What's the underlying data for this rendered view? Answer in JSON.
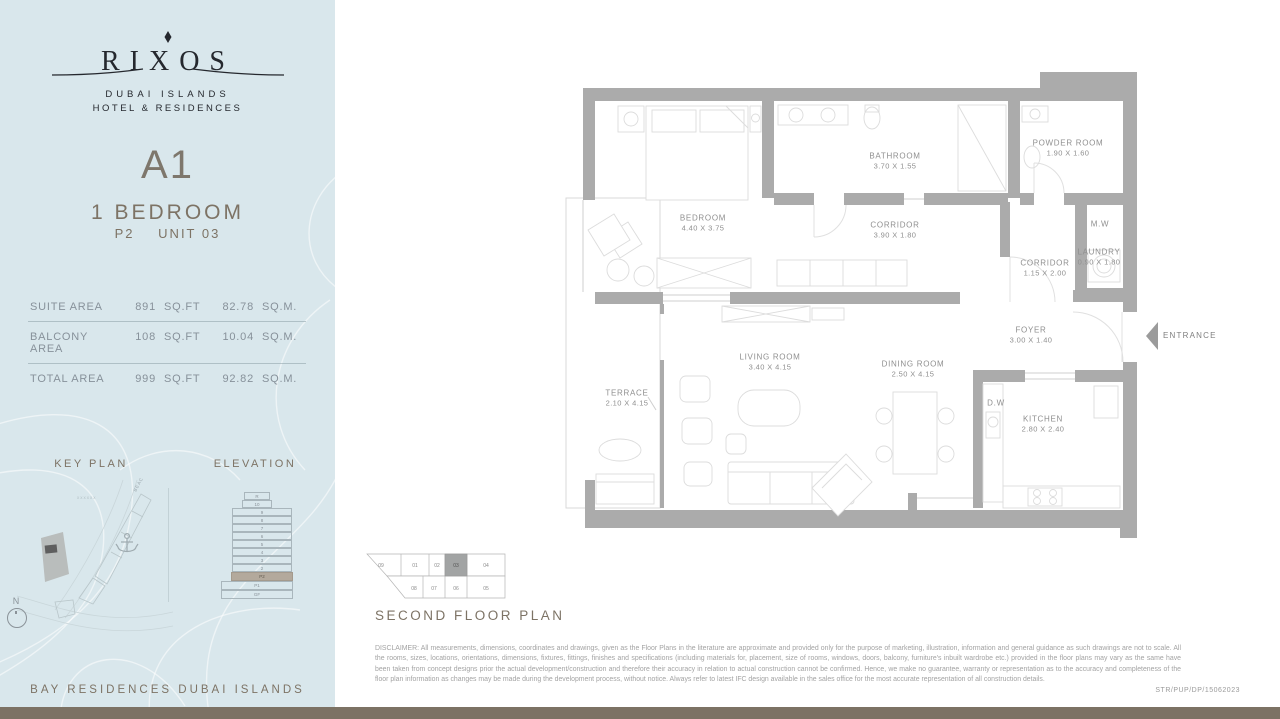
{
  "brand": {
    "name": "RIXOS",
    "sub1": "DUBAI ISLANDS",
    "sub2": "HOTEL & RESIDENCES"
  },
  "unit": {
    "code": "A1",
    "type": "1 BEDROOM",
    "level": "P2",
    "number": "UNIT 03"
  },
  "area_table": {
    "rows": [
      {
        "label": "SUITE AREA",
        "sqft": "891",
        "sqft_unit": "SQ.FT",
        "sqm": "82.78",
        "sqm_unit": "SQ.M."
      },
      {
        "label": "BALCONY AREA",
        "sqft": "108",
        "sqft_unit": "SQ.FT",
        "sqm": "10.04",
        "sqm_unit": "SQ.M."
      },
      {
        "label": "TOTAL AREA",
        "sqft": "999",
        "sqft_unit": "SQ.FT",
        "sqm": "92.82",
        "sqm_unit": "SQ.M."
      }
    ]
  },
  "key_plan": {
    "title": "KEY PLAN",
    "road_label": "BEACH VILLAS",
    "compass_label": "N"
  },
  "elevation": {
    "title": "ELEVATION",
    "floors": [
      "R",
      "10",
      "9",
      "8",
      "7",
      "6",
      "5",
      "4",
      "3",
      "2",
      "P2",
      "P1",
      "GF"
    ],
    "highlighted_floor": "P2"
  },
  "project_footer": "BAY RESIDENCES DUBAI ISLANDS",
  "floor_plan": {
    "title": "SECOND FLOOR PLAN",
    "entrance_label": "ENTRANCE",
    "rooms": [
      {
        "name": "BEDROOM",
        "dims": "4.40 X 3.75"
      },
      {
        "name": "BATHROOM",
        "dims": "3.70 X 1.55"
      },
      {
        "name": "POWDER ROOM",
        "dims": "1.90 X 1.60"
      },
      {
        "name": "CORRIDOR",
        "dims": "3.90 X 1.80"
      },
      {
        "name": "M.W",
        "dims": ""
      },
      {
        "name": "LAUNDRY",
        "dims": "0.90 X 1.80"
      },
      {
        "name": "CORRIDOR",
        "dims": "1.15 X 2.00"
      },
      {
        "name": "FOYER",
        "dims": "3.00 X 1.40"
      },
      {
        "name": "TERRACE",
        "dims": "2.10 X 4.15"
      },
      {
        "name": "LIVING ROOM",
        "dims": "3.40 X 4.15"
      },
      {
        "name": "DINING ROOM",
        "dims": "2.50 X 4.15"
      },
      {
        "name": "D.W",
        "dims": ""
      },
      {
        "name": "KITCHEN",
        "dims": "2.80 X 2.40"
      }
    ],
    "unit_selector": {
      "top_row": [
        "09",
        "01",
        "02",
        "03",
        "04"
      ],
      "bottom_row": [
        "08",
        "07",
        "06",
        "05"
      ],
      "active_unit": "03"
    }
  },
  "disclaimer": "DISCLAIMER: All measurements, dimensions, coordinates and drawings, given as the Floor Plans in the literature are approximate and provided only for the purpose of marketing, illustration, information and general guidance as such drawings are not to scale. All the rooms, sizes, locations, orientations, dimensions, fixtures, fittings, finishes and specifications (including materials for, placement, size of rooms, windows, doors, balcony, furniture's inbuilt wardrobe etc.) provided in the floor plans may vary as the same have been taken from concept designs prior the actual development/construction and therefore their accuracy in relation to actual construction cannot be confirmed. Hence, we make no guarantee, warranty or representation as to the accuracy and completeness of the floor plan information as changes may be made during the development process, without notice. Always refer to latest IFC design available in the sales office for the most accurate representation of all construction details.",
  "doc_ref": "STR/PUP/DP/15062023",
  "colors": {
    "sidebar_bg": "#d9e7ec",
    "wall_gray": "#ababab",
    "accent_taupe": "#7d7365",
    "bottom_bar": "#7c7264",
    "highlight_floor": "#b3a99c",
    "active_unit_cell": "#a2a4a4"
  }
}
